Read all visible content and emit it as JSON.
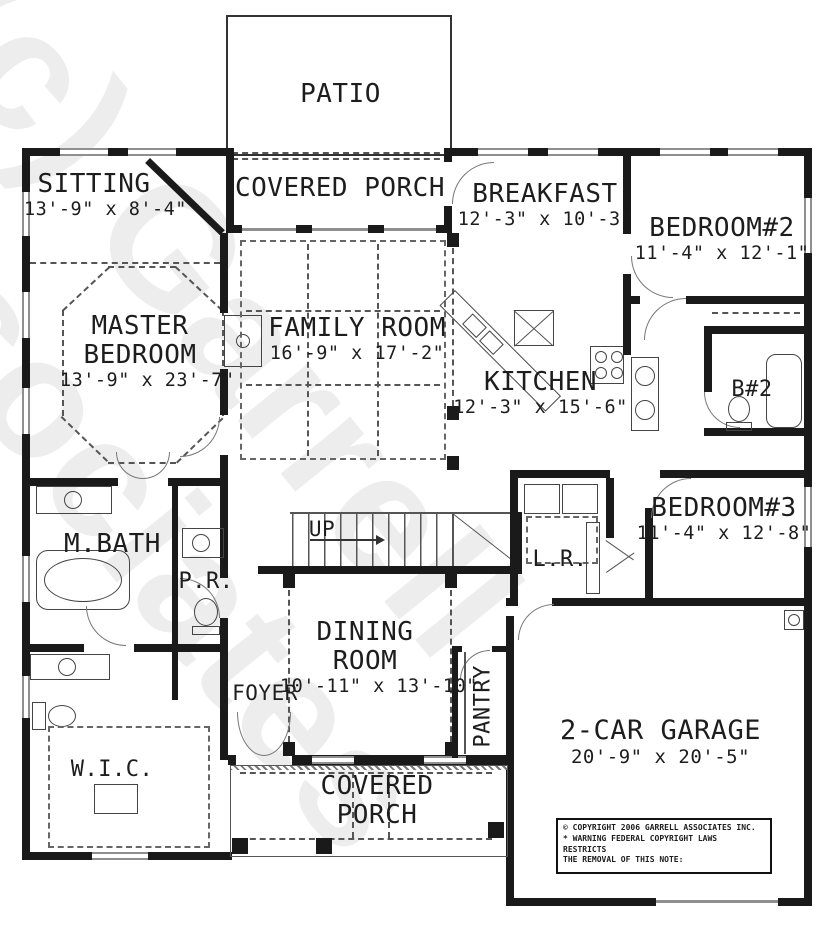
{
  "watermark": "(c) Garrell\nAssociates",
  "rooms": {
    "patio": {
      "label": "PATIO"
    },
    "covered_porch_top": {
      "label": "COVERED PORCH"
    },
    "sitting": {
      "label": "SITTING",
      "dims": "13'-9\" x 8'-4\""
    },
    "breakfast": {
      "label": "BREAKFAST",
      "dims": "12'-3\" x 10'-3\""
    },
    "bedroom2": {
      "label": "BEDROOM#2",
      "dims": "11'-4\" x 12'-1\""
    },
    "master_bedroom": {
      "label": "MASTER BEDROOM",
      "dims": "13'-9\" x 23'-7\""
    },
    "family_room": {
      "label": "FAMILY ROOM",
      "dims": "16'-9\" x 17'-2\""
    },
    "kitchen": {
      "label": "KITCHEN",
      "dims": "12'-3\" x 15'-6\""
    },
    "bath2": {
      "label": "B#2"
    },
    "bedroom3": {
      "label": "BEDROOM#3",
      "dims": "11'-4\" x 12'-8\""
    },
    "master_bath": {
      "label": "M.BATH"
    },
    "powder_room": {
      "label": "P.R."
    },
    "stairs": {
      "label": "UP"
    },
    "laundry": {
      "label": "L.R."
    },
    "dining": {
      "label": "DINING ROOM",
      "dims": "10'-11\" x 13'-10\""
    },
    "foyer": {
      "label": "FOYER"
    },
    "pantry": {
      "label": "PANTRY"
    },
    "wic": {
      "label": "W.I.C."
    },
    "covered_porch_bottom": {
      "label": "COVERED PORCH"
    },
    "garage": {
      "label": "2-CAR GARAGE",
      "dims": "20'-9\" x 20'-5\""
    }
  },
  "copyright": {
    "line1": "© COPYRIGHT 2006 GARRELL ASSOCIATES INC.",
    "line2": "* WARNING FEDERAL COPYRIGHT LAWS RESTRICTS",
    "line3": "THE REMOVAL OF THIS NOTE:"
  },
  "colors": {
    "wall": "#1a1a1a",
    "watermark": "#e8e8e8",
    "window": "#8f8f8f"
  }
}
